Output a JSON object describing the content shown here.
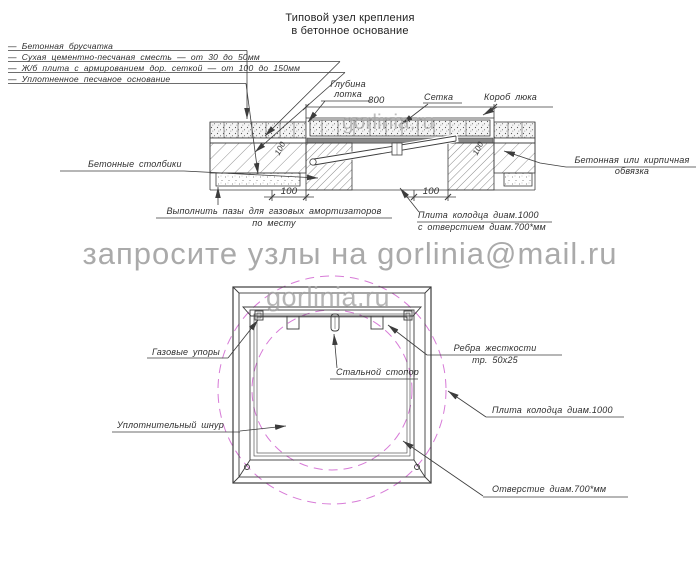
{
  "meta": {
    "line_color": "#3c3c3c",
    "accent_color": "#d77bd7",
    "watermark_color": "#a3a3a3"
  },
  "title": {
    "line1": "Типовой узел крепления",
    "line2": "в бетонное основание"
  },
  "legend": {
    "item1": "—  Бетонная брусчатка",
    "item2": "—  Сухая цементно-песчаная сместь — от 30 до 50мм",
    "item3": "—  Ж/б плита с армированием дор. сеткой — от 100 до 150мм",
    "item4": "—  Уплотненное песчаное основание"
  },
  "section": {
    "labels": {
      "glubina1": "Глубина",
      "glubina2": "лотка",
      "setka": "Сетка",
      "korob": "Короб люка",
      "stolbiki": "Бетонные столбики",
      "obvyazka1": "Бетонная или кирпичная",
      "obvyazka2": "обвязка",
      "pazy1": "Выполнить пазы для газовых амортизаторов",
      "pazy2": "по месту",
      "plita1": "Плита колодца диам.1000",
      "plita2": "с отверстием диам.700*мм"
    },
    "dims": {
      "width": "800",
      "col_left": "100",
      "col_right": "100",
      "rot_left": "100",
      "rot_right": "100"
    }
  },
  "plan": {
    "labels": {
      "gas": "Газовые упоры",
      "stopor": "Стальной стопор",
      "rebra1": "Ребра жесткости",
      "rebra2": "тр. 50х25",
      "plita": "Плита колодца диам.1000",
      "shnur": "Уплотнительный шнур",
      "otverstie": "Отверстие диам.700*мм"
    }
  },
  "watermarks": {
    "email": "запросите узлы на gorlinia@mail.ru",
    "site": "gorlinia.ru",
    "site_top": "gorlinia.ru"
  }
}
